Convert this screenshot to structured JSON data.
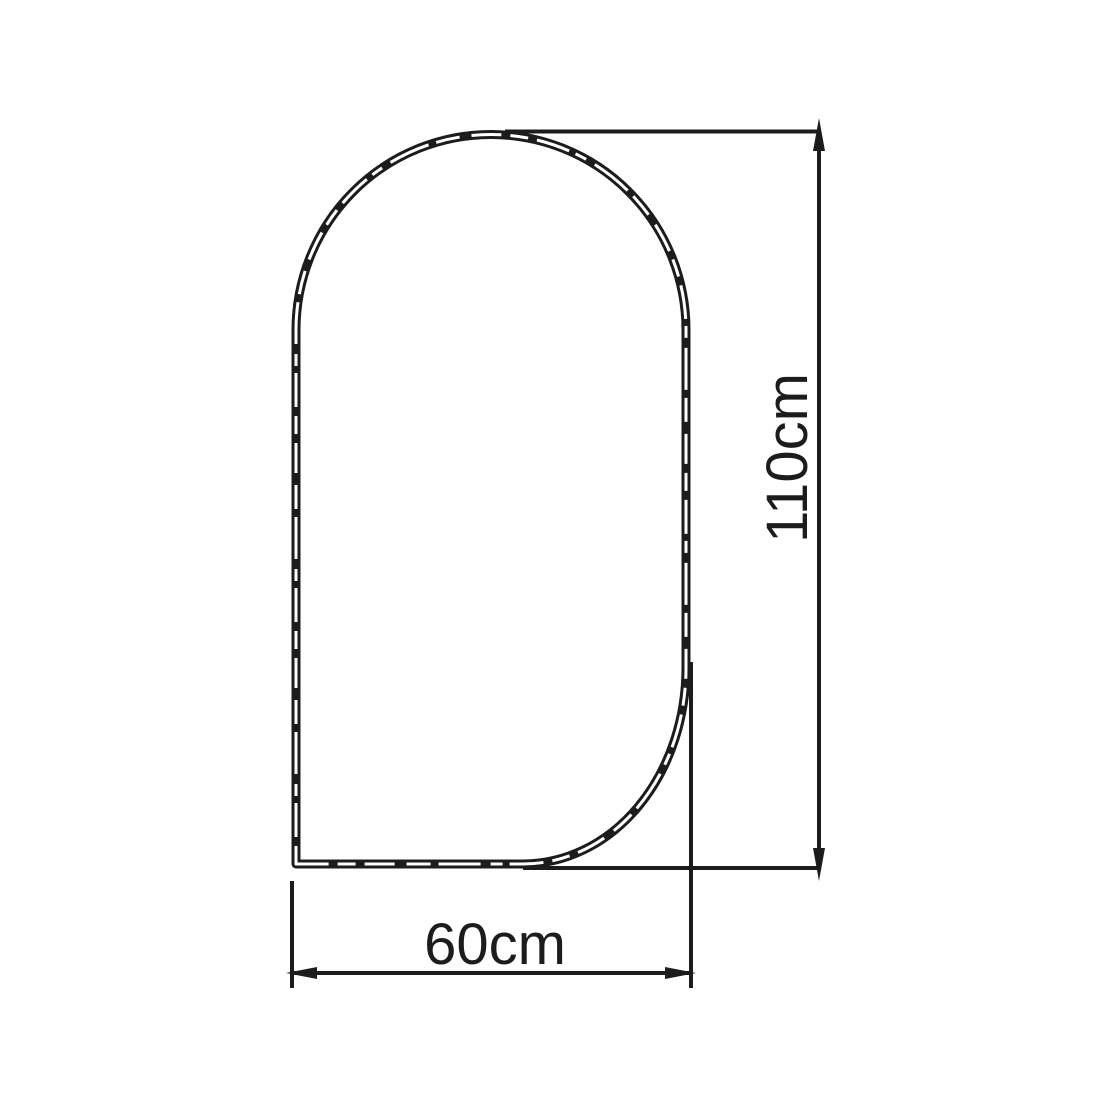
{
  "diagram": {
    "type": "technical-dimension-drawing",
    "subject": "arched panel outline (flat bottom, square bottom-left corner, rounded bottom-right corner, semicircular arch top)",
    "background_color": "#ffffff",
    "line_color": "#1c1c1c",
    "dimensions": {
      "height": {
        "label": "110cm",
        "value": 110,
        "unit": "cm",
        "orientation": "vertical"
      },
      "width": {
        "label": "60cm",
        "value": 60,
        "unit": "cm",
        "orientation": "horizontal"
      }
    }
  }
}
